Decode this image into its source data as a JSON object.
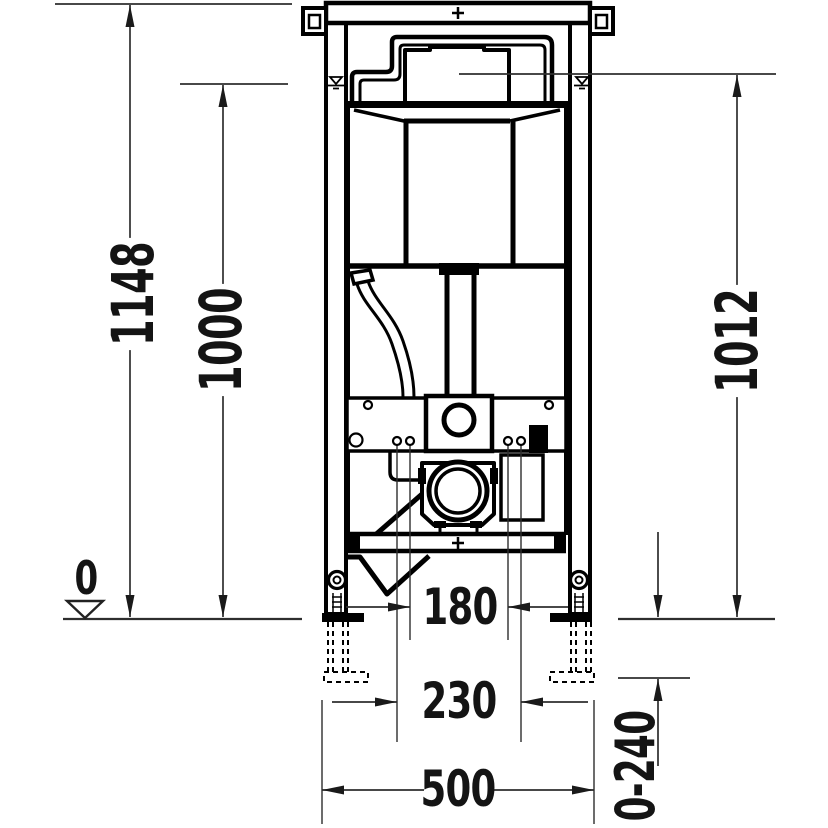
{
  "drawing": {
    "background": "#ffffff",
    "line_color": "#000000",
    "dimension_line_color": "#2e2e2e"
  },
  "dimensions": {
    "total_height": "1148",
    "upper_reference_height": "1000",
    "water_level_height": "1012",
    "floor_datum": "0",
    "bolt_spacing_inner": "180",
    "bolt_spacing_outer": "230",
    "frame_width": "500",
    "foot_adjustment_range": "0-240"
  }
}
